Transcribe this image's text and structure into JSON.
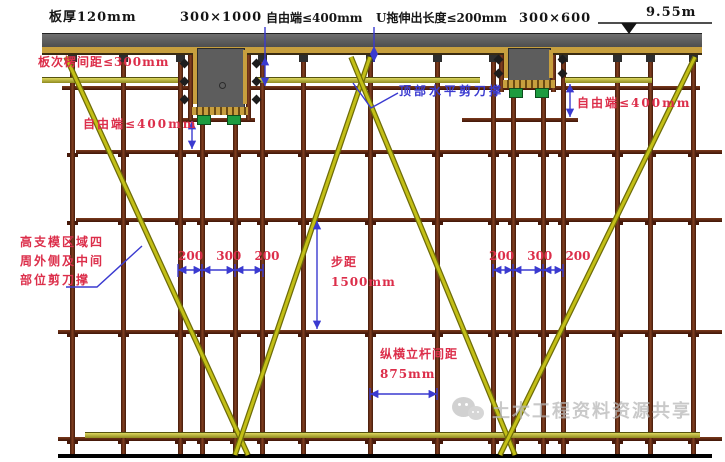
{
  "labels": {
    "slab_thickness": "板厚120mm",
    "beam_main_size": "300×1000",
    "free_end_top": "自由端≤400mm",
    "u_head_extension": "U拖伸出长度≤200mm",
    "beam_secondary_size": "300×600",
    "elevation": "9.55m",
    "slab_joist_spacing": "板次楞间距≤300mm",
    "free_end_left": "自由端≤400mm",
    "top_horizontal_shear_brace": "顶部水平剪刀撑",
    "free_end_right": "自由端≤400mm",
    "shear_brace_note": "高支模区域四\n周外侧及中间\n部位剪刀撑",
    "spacing_chain_left": "200 300 200",
    "spacing_chain_right": "200 300 200",
    "step_distance": "步距\n1500mm",
    "pole_spacing": "纵横立杆间距\n875mm",
    "watermark": "土木工程资料资源共享"
  },
  "colors": {
    "annotation_red": "#dc2e4a",
    "dimension_blue": "#3a3ad0",
    "brace_yellow": "#c3bf17",
    "steel_tube_brown": "#6a2f16",
    "plywood_tan": "#c79f3e",
    "concrete_gray": "#5d5d5d",
    "u_head_green": "#1d9c3f"
  },
  "icons": {
    "watermark_icon": "wechat-logo"
  }
}
